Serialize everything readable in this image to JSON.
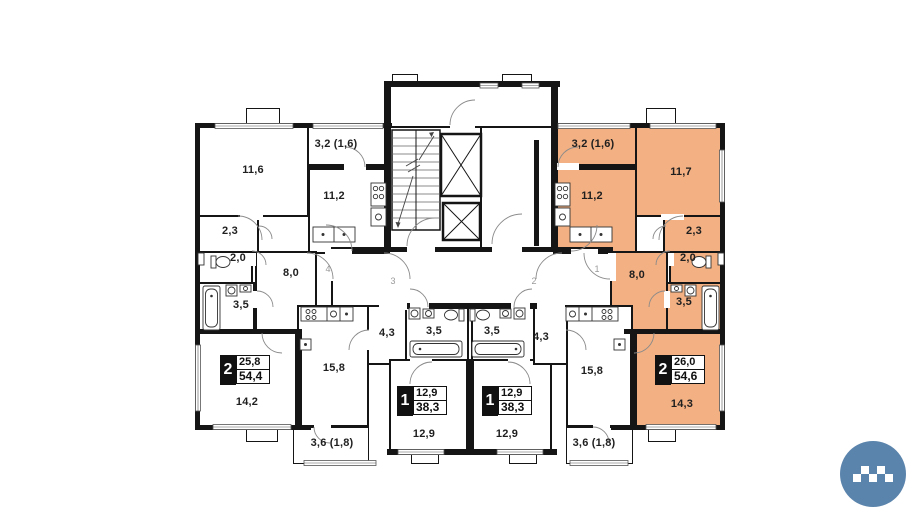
{
  "colors": {
    "highlight": "#f2b083",
    "wall": "#151515",
    "logo-blue": "#5b84ac"
  },
  "units": {
    "left2": {
      "number": "4",
      "badge": {
        "type": "2",
        "living": "25,8",
        "total": "54,4"
      },
      "rooms": {
        "bed1": "11,6",
        "balcony": "3,2 (1,6)",
        "kitchen": "11,2",
        "hall": "2,3",
        "wc": "2,0",
        "bath": "3,5",
        "corridor": "8,0",
        "living": "14,2"
      }
    },
    "unit3": {
      "number": "3",
      "badge": {
        "type": "1",
        "living": "12,9",
        "total": "38,3"
      },
      "rooms": {
        "living": "15,8",
        "balcony": "3,6 (1,8)",
        "corridor": "4,3",
        "bath": "3,5",
        "bedroom": "12,9"
      }
    },
    "unit2": {
      "number": "2",
      "badge": {
        "type": "1",
        "living": "12,9",
        "total": "38,3"
      },
      "rooms": {
        "living": "15,8",
        "balcony": "3,6 (1,8)",
        "corridor": "4,3",
        "bath": "3,5",
        "bedroom": "12,9"
      }
    },
    "right2": {
      "number": "1",
      "badge": {
        "type": "2",
        "living": "26,0",
        "total": "54,6"
      },
      "rooms": {
        "bed1": "11,7",
        "balcony": "3,2 (1,6)",
        "kitchen": "11,2",
        "hall": "2,3",
        "wc": "2,0",
        "bath": "3,5",
        "corridor": "8,0",
        "living": "14,3"
      }
    }
  }
}
